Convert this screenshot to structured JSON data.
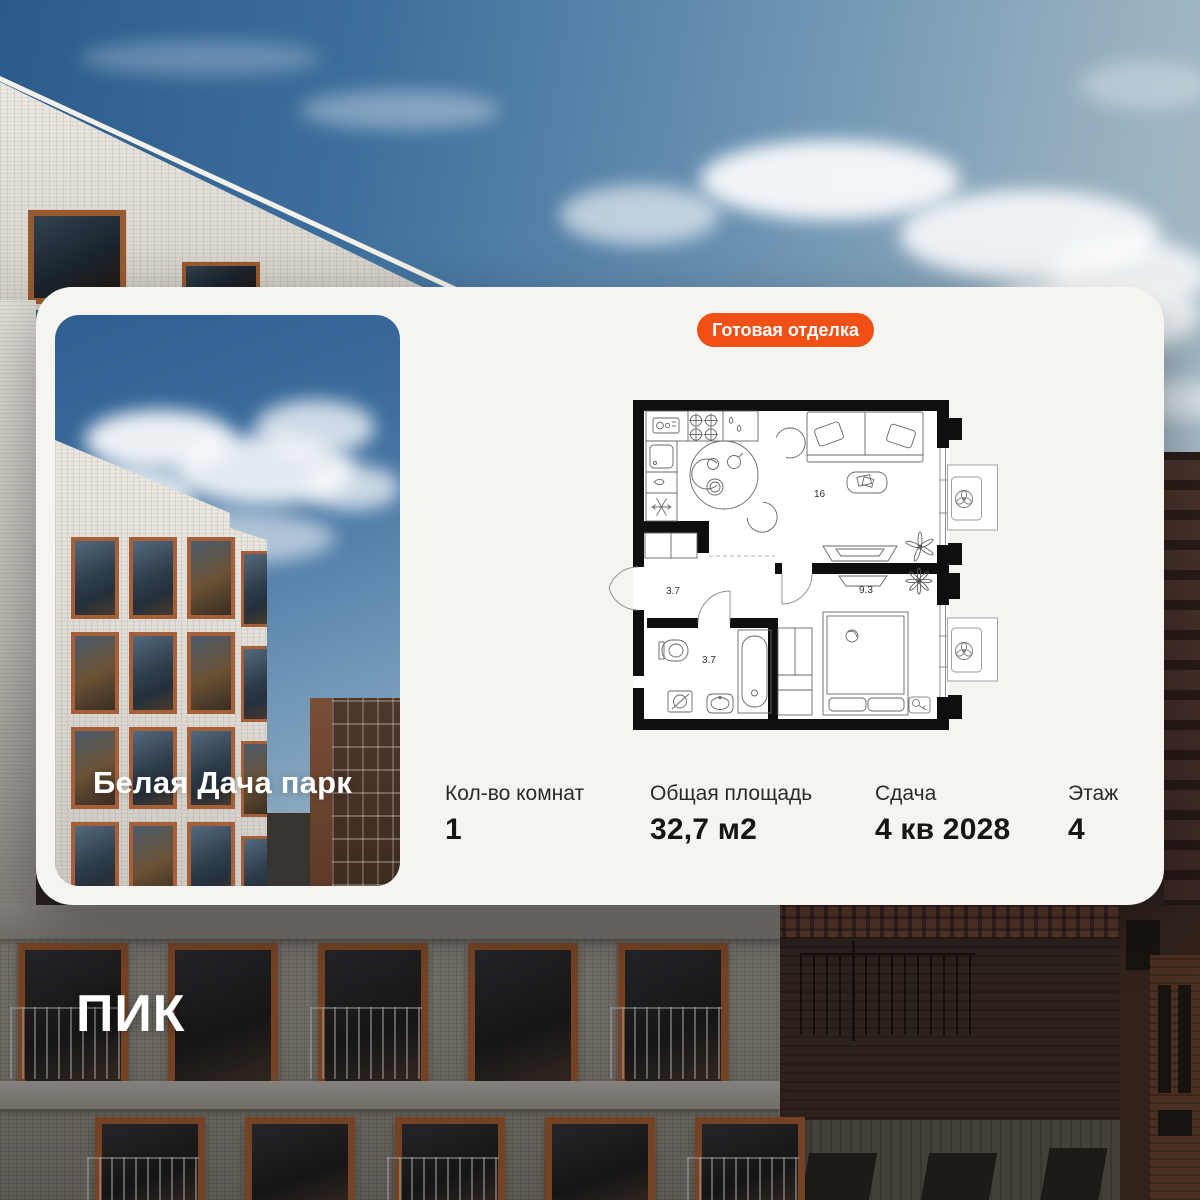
{
  "badge": {
    "label": "Готовая отделка",
    "bg": "#F04F16",
    "text_color": "#FFFFFF"
  },
  "project": {
    "name": "Белая Дача парк"
  },
  "logo": {
    "text": "ПИК"
  },
  "stats": [
    {
      "label": "Кол-во комнат",
      "value": "1"
    },
    {
      "label": "Общая площадь",
      "value": "32,7 м2"
    },
    {
      "label": "Сдача",
      "value": "4 кв 2028"
    },
    {
      "label": "Этаж",
      "value": "4"
    }
  ],
  "floor_plan": {
    "rooms": [
      {
        "name": "hallway",
        "area": "3.7"
      },
      {
        "name": "bathroom",
        "area": "3.7"
      },
      {
        "name": "living-kitchen",
        "area": "16"
      },
      {
        "name": "bedroom",
        "area": "9.3"
      }
    ]
  },
  "colors": {
    "accent_orange": "#F04F16",
    "card_bg": "#F6F4F0",
    "wall_black": "#0F0F0F"
  }
}
